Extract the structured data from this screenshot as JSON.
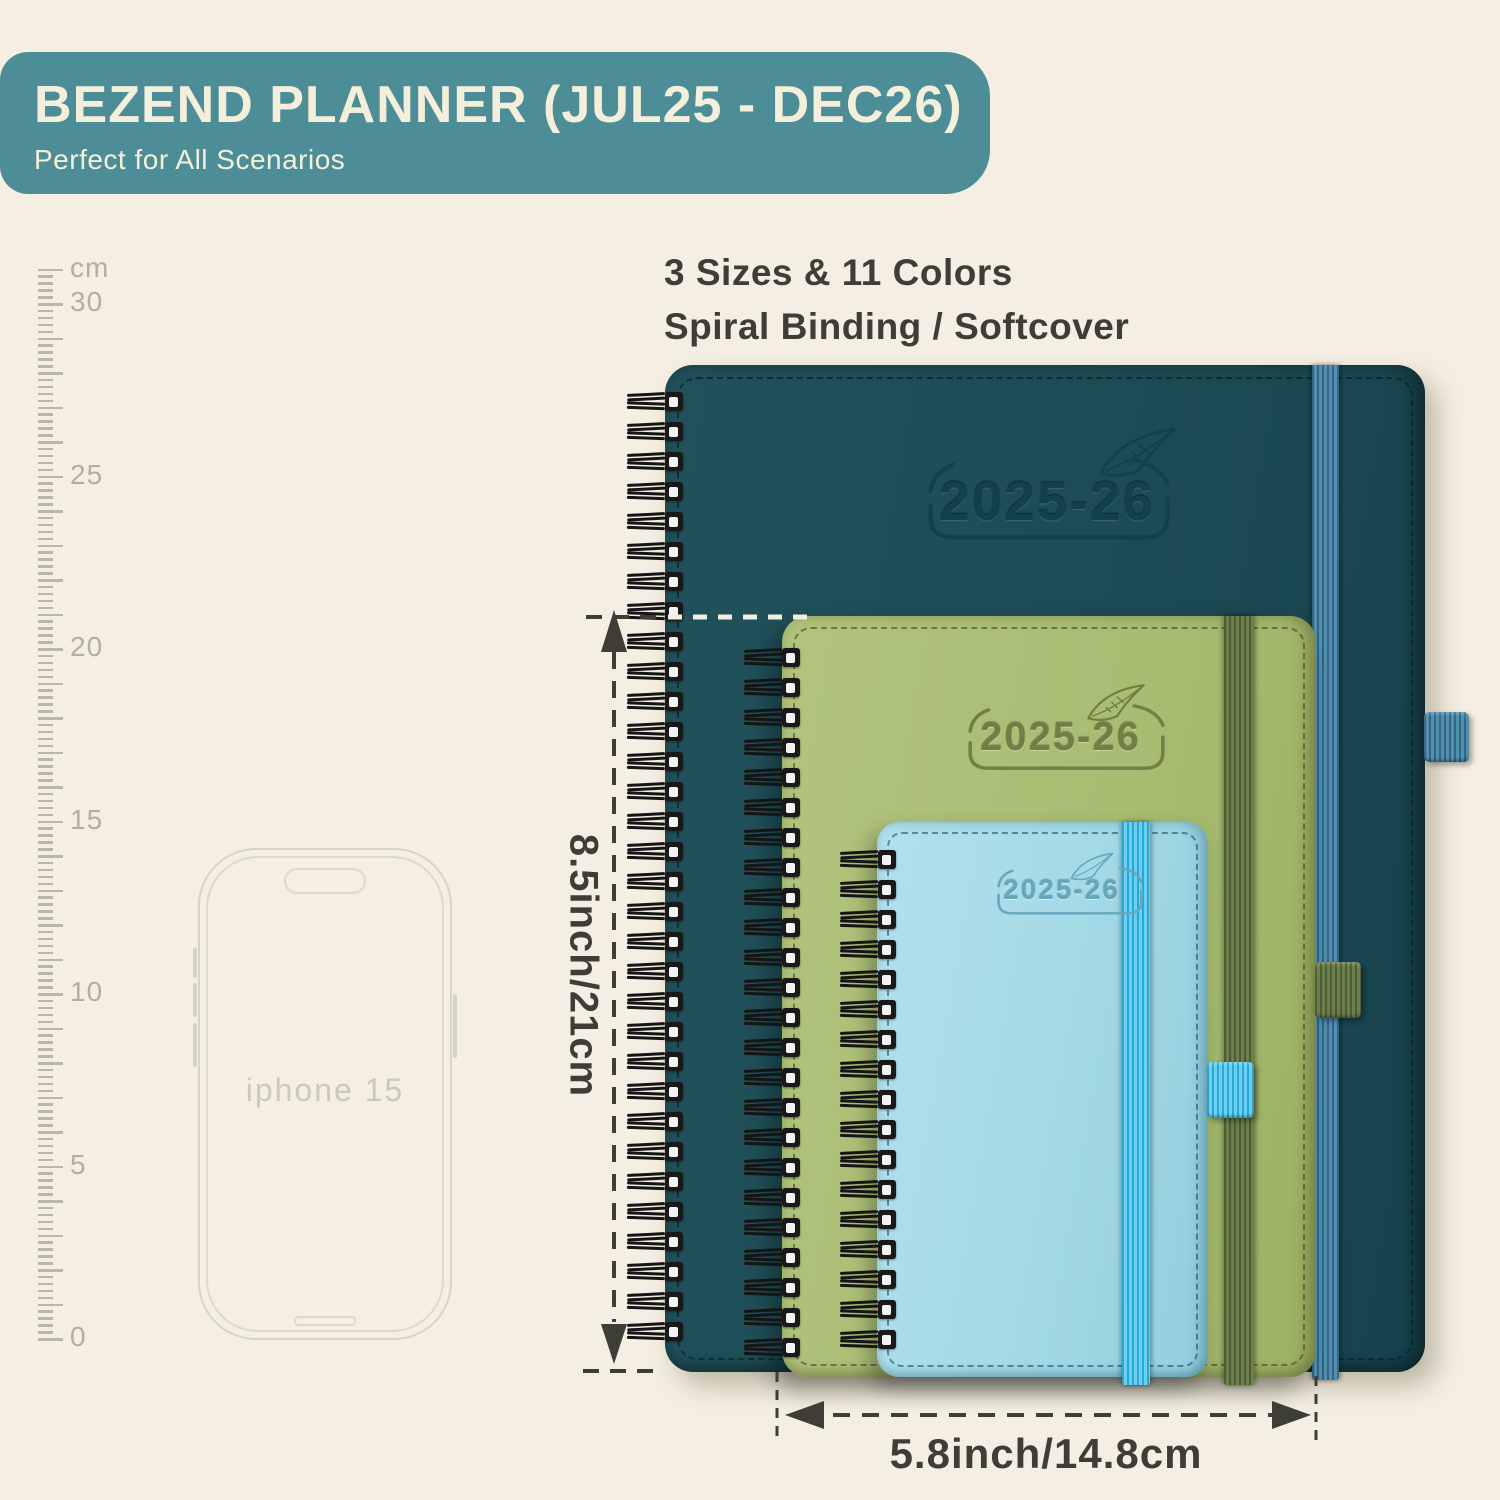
{
  "page": {
    "background": "#f4efe2"
  },
  "banner": {
    "title": "BEZEND PLANNER (JUL25 - DEC26)",
    "subtitle": "Perfect for All Scenarios",
    "bg_color": "#4d8d98",
    "text_color": "#f4efda"
  },
  "features": {
    "line1": "3 Sizes & 11 Colors",
    "line2": "Spiral Binding / Softcover"
  },
  "ruler": {
    "unit": "cm",
    "top_value": 31,
    "major_labels": [
      30,
      25,
      20,
      15,
      10,
      5,
      0
    ]
  },
  "phone": {
    "label": "iphone 15"
  },
  "planners": [
    {
      "size": "large",
      "year": "2025-26",
      "cover_color": "#1d4b53",
      "elastic_color": "#4f8cab"
    },
    {
      "size": "medium",
      "year": "2025-26",
      "cover_color": "#a8bc72",
      "elastic_color": "#5c6b3f"
    },
    {
      "size": "small",
      "year": "2025-26",
      "cover_color": "#a3d9e6",
      "elastic_color": "#41bce8"
    }
  ],
  "dimensions": {
    "height": "8.5inch/21cm",
    "width": "5.8inch/14.8cm"
  }
}
